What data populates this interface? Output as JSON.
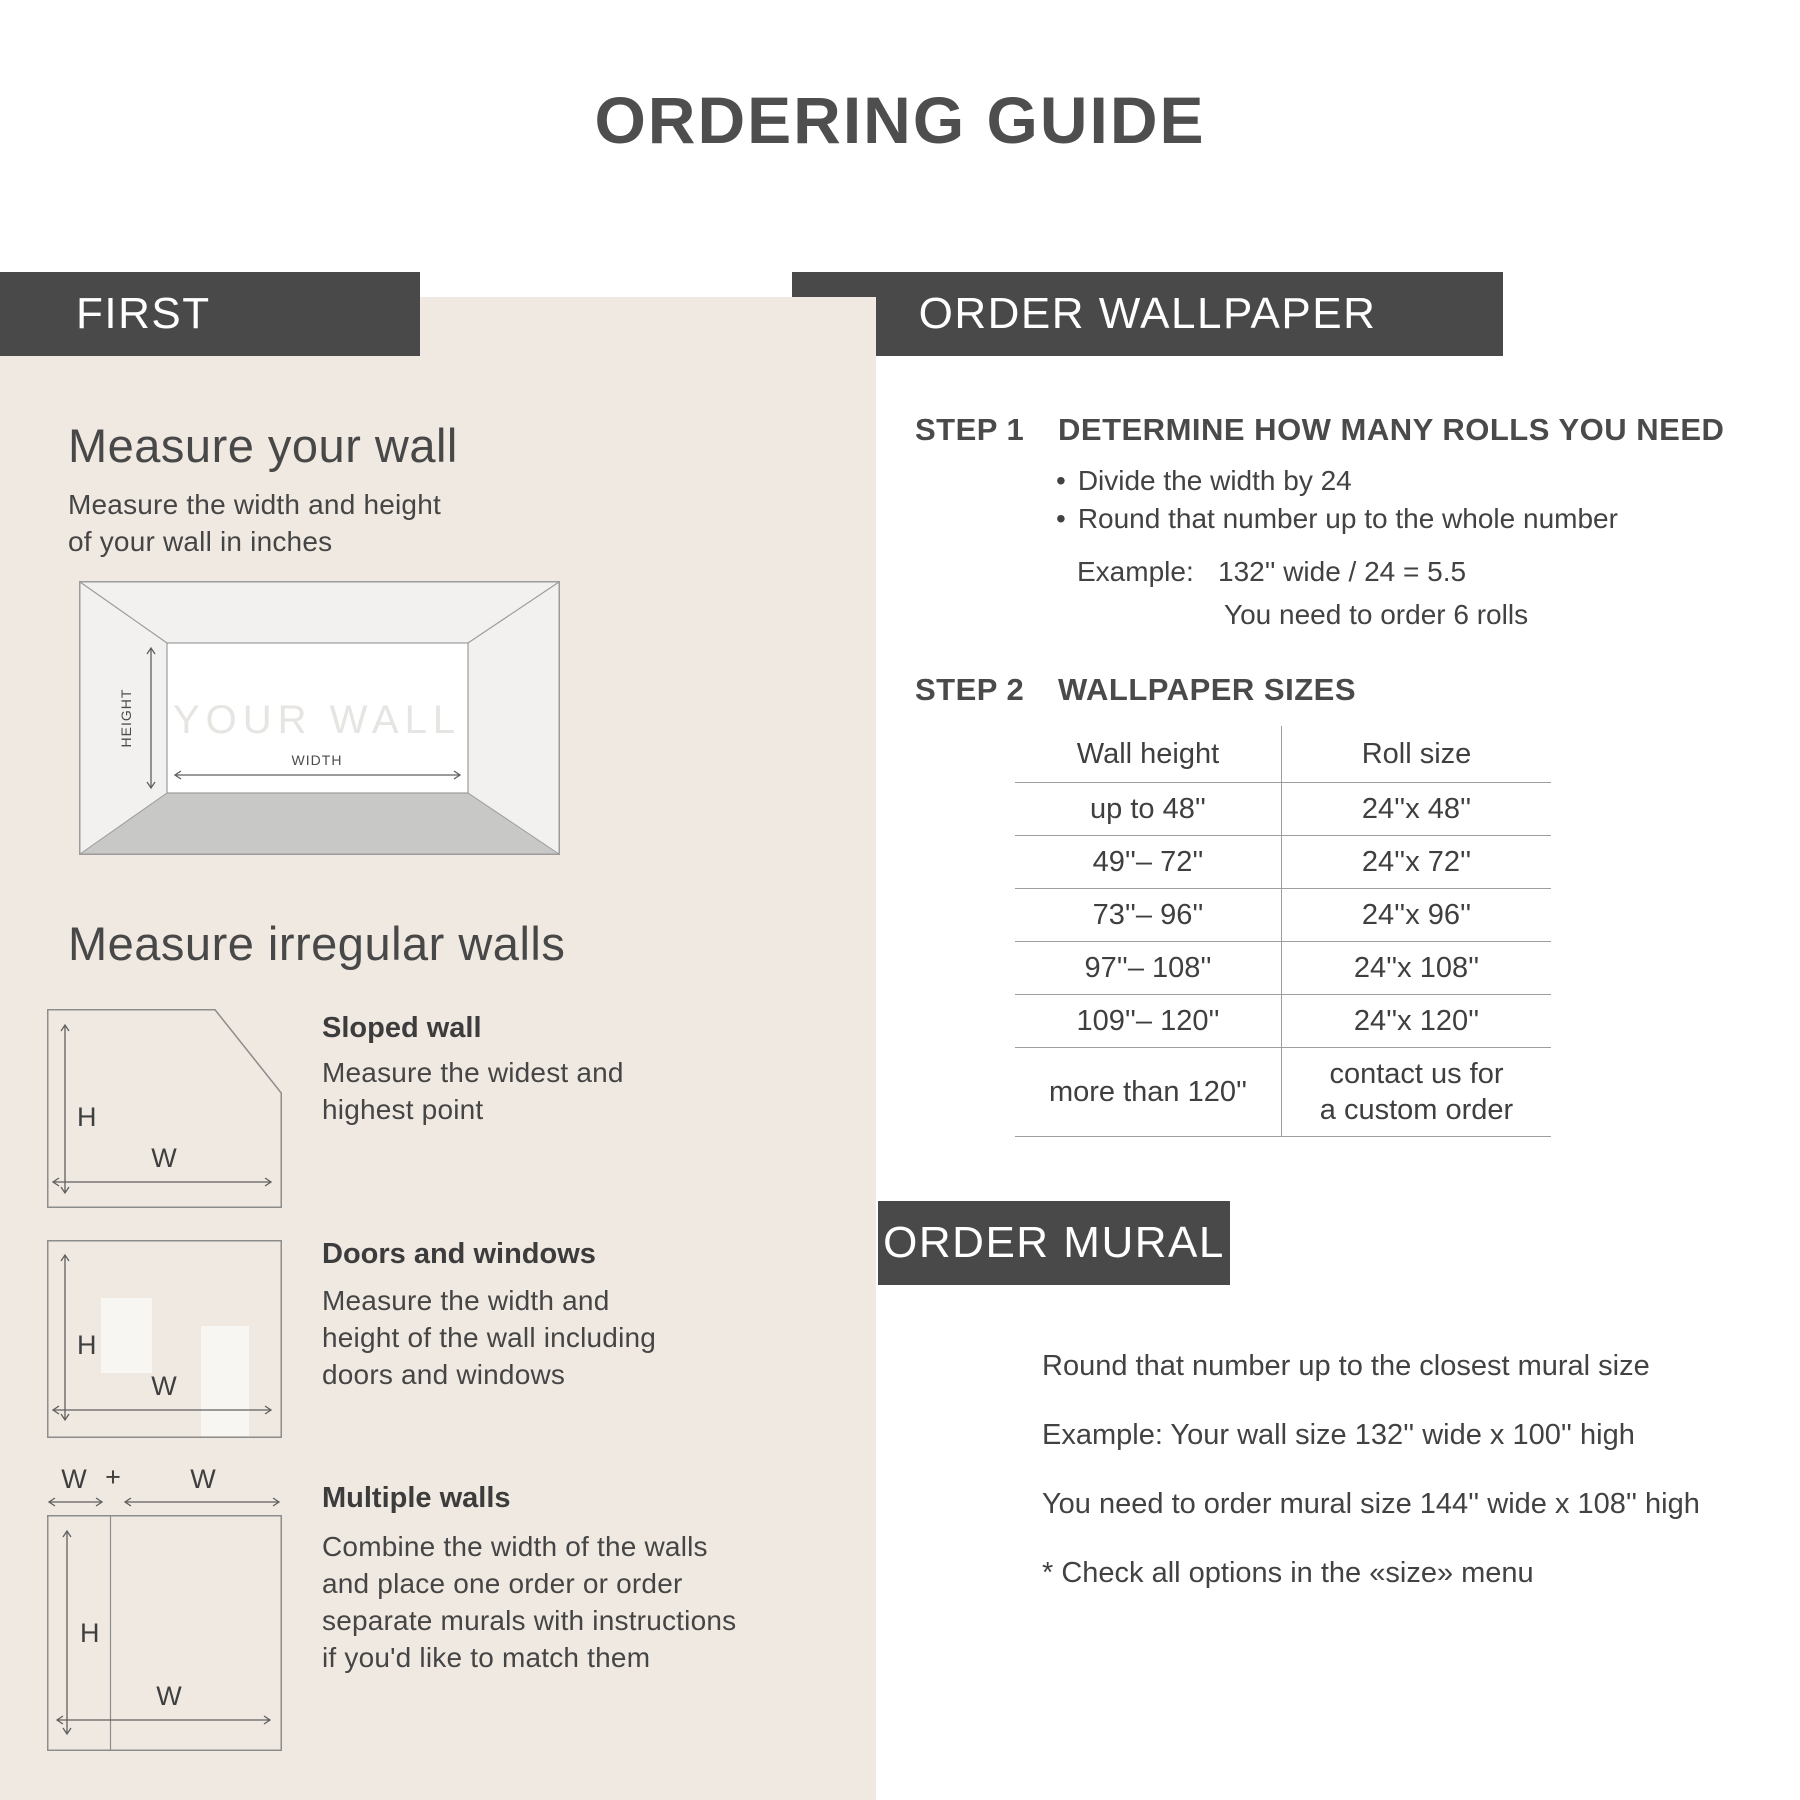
{
  "title": "ORDERING GUIDE",
  "colors": {
    "panel_beige": "#f0e9e1",
    "bar_gray": "#494949",
    "text_dark": "#414141",
    "floor_gray": "#c8c8c7",
    "wall_fill": "#f2f1ef"
  },
  "left": {
    "bar_label": "FIRST",
    "measure_wall": {
      "heading": "Measure your wall",
      "body": "Measure the width and height\nof your wall in inches",
      "diagram": {
        "your_wall": "YOUR WALL",
        "height_label": "HEIGHT",
        "width_label": "WIDTH"
      }
    },
    "irregular": {
      "heading": "Measure irregular walls",
      "items": [
        {
          "title": "Sloped wall",
          "body": "Measure the widest and\nhighest point",
          "h_label": "H",
          "w_label": "W"
        },
        {
          "title": "Doors and windows",
          "body": "Measure the width and\nheight of the wall including\ndoors and windows",
          "h_label": "H",
          "w_label": "W"
        },
        {
          "title": "Multiple walls",
          "body": "Combine the width of the walls\nand place one order or order\nseparate murals with instructions\nif you'd like to match them",
          "h_label": "H",
          "w_label": "W",
          "top_w1": "W",
          "plus": "+",
          "top_w2": "W"
        }
      ]
    }
  },
  "right": {
    "wallpaper_bar_label": "ORDER WALLPAPER",
    "step1": {
      "label": "STEP 1",
      "heading": "DETERMINE HOW MANY ROLLS YOU NEED",
      "bullets": [
        "Divide the width by 24",
        "Round that number up to the whole number"
      ],
      "example_label": "Example:",
      "example_value": "132'' wide / 24 = 5.5",
      "example_note": "You need to order 6 rolls"
    },
    "step2": {
      "label": "STEP 2",
      "heading": "WALLPAPER SIZES",
      "table": {
        "col1_header": "Wall height",
        "col2_header": "Roll size",
        "rows": [
          [
            "up to 48''",
            "24''x 48''"
          ],
          [
            "49''– 72''",
            "24''x 72''"
          ],
          [
            "73''– 96''",
            "24''x 96''"
          ],
          [
            "97''– 108''",
            "24''x 108''"
          ],
          [
            "109''– 120''",
            "24''x 120''"
          ],
          [
            "more than 120''",
            "contact us for\na custom order"
          ]
        ]
      }
    },
    "mural_bar_label": "ORDER MURAL",
    "mural": {
      "body": "Round that number up to the closest mural size\nExample: Your wall size 132'' wide x 100'' high\nYou need to order mural size 144'' wide x 108'' high\n* Check all options in the «size» menu"
    }
  }
}
